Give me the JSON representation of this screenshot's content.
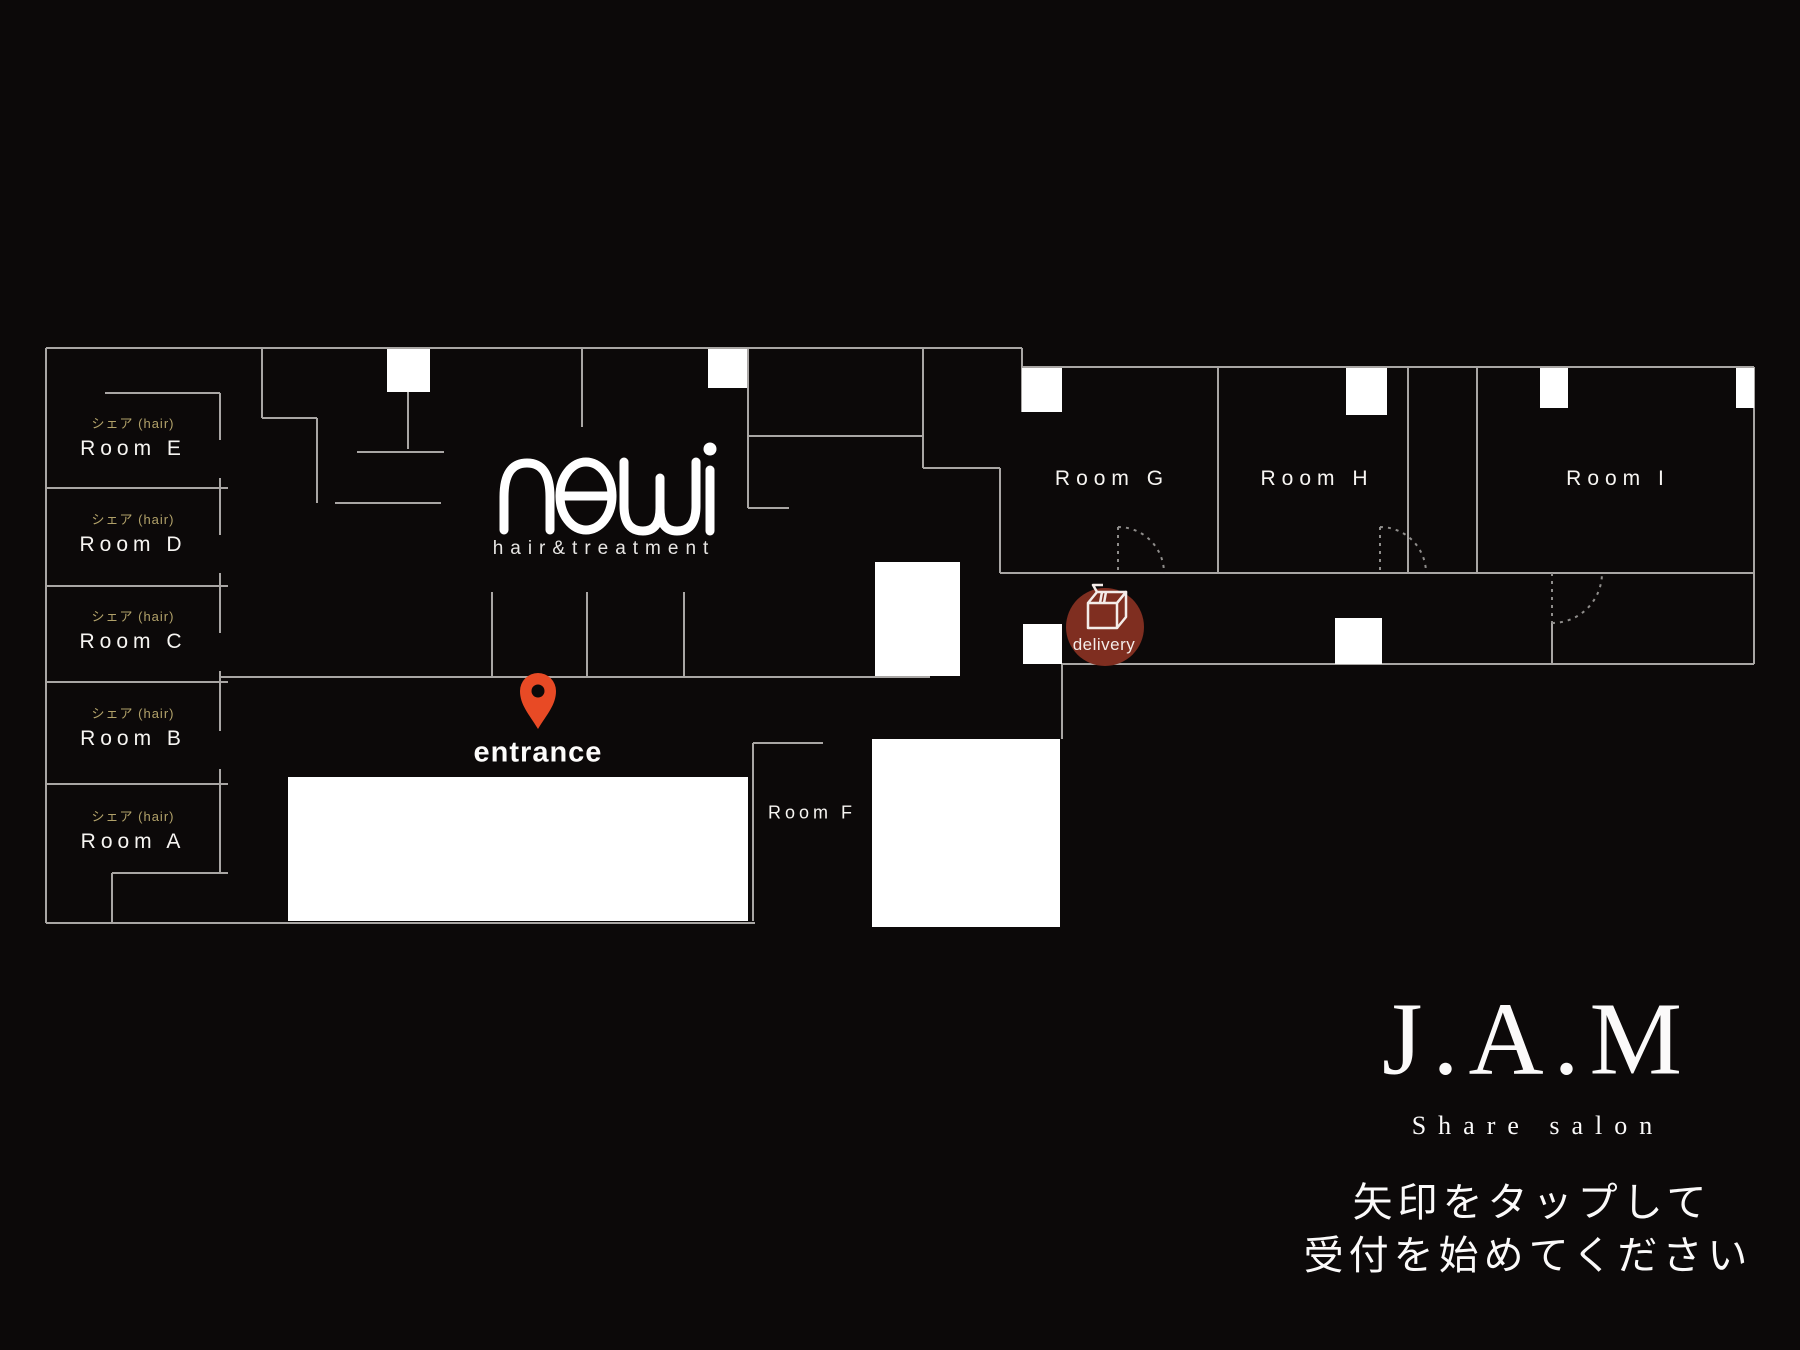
{
  "meta": {
    "app": "JAM share salon reception floor map"
  },
  "colors": {
    "background": "#0c0909",
    "wall_line": "#a9a6a4",
    "door_dotted": "#8f8d8b",
    "white_fill": "#ffffff",
    "share_label": "#b1a169",
    "pin_accent": "#e84a25",
    "delivery_badge": "#7f2e20"
  },
  "left_rooms": [
    {
      "type": "シェア (hair)",
      "name": "Room E"
    },
    {
      "type": "シェア (hair)",
      "name": "Room D"
    },
    {
      "type": "シェア (hair)",
      "name": "Room C"
    },
    {
      "type": "シェア (hair)",
      "name": "Room B"
    },
    {
      "type": "シェア (hair)",
      "name": "Room A"
    }
  ],
  "right_rooms": [
    {
      "name": "Room G"
    },
    {
      "name": "Room H"
    },
    {
      "name": "Room I"
    }
  ],
  "room_f": {
    "name": "Room F"
  },
  "entrance": {
    "label": "entrance"
  },
  "delivery": {
    "label": "delivery"
  },
  "brand_newi": {
    "name": "newi",
    "tagline": "hair&treatment"
  },
  "brand_jam": {
    "name": "J.A.M",
    "subtitle": "Share salon"
  },
  "instructions": {
    "line1": "矢印をタップして",
    "line2": "受付を始めてください"
  }
}
